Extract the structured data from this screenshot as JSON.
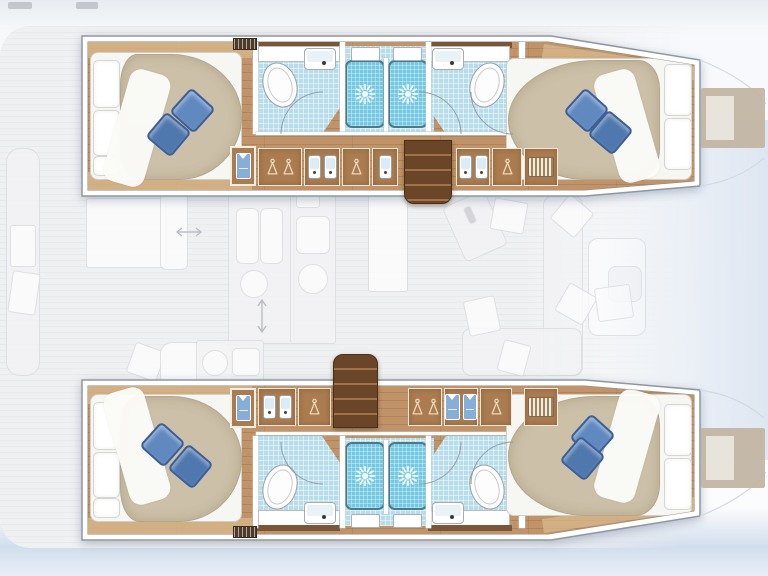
{
  "plan": {
    "vessel_type": "sailing catamaran",
    "view": "top-down interior deck plan, no text labels",
    "orientation": {
      "bow": "right",
      "stern": "left"
    },
    "hulls": [
      {
        "id": "port-hull",
        "position": "top",
        "rooms": [
          {
            "name": "aft cabin",
            "items": [
              "double bed",
              "3 white pillows",
              "2 blue decor pillows",
              "hanging locker with folded shirt",
              "louvre vent"
            ]
          },
          {
            "name": "aft bathroom",
            "items": [
              "toilet",
              "washbasin with faucet",
              "shower stall with shower rose",
              "roof hatch"
            ]
          },
          {
            "name": "corridor",
            "items": [
              "staircase down from saloon",
              "wardrobe hangers",
              "twin vanity basins",
              "single basin",
              "linen grill locker"
            ]
          },
          {
            "name": "forward bathroom",
            "items": [
              "toilet",
              "washbasin with faucet",
              "shower stall with shower rose",
              "roof hatch"
            ]
          },
          {
            "name": "forward cabin",
            "items": [
              "double bed",
              "2 white pillows",
              "2 blue decor pillows"
            ]
          },
          {
            "name": "bow",
            "items": [
              "sunpad"
            ]
          }
        ]
      },
      {
        "id": "starboard-hull",
        "position": "bottom",
        "rooms": [
          {
            "name": "aft cabin",
            "items": [
              "double bed",
              "3 white pillows",
              "2 blue decor pillows",
              "hanging locker with folded shirt",
              "louvre vent"
            ]
          },
          {
            "name": "aft bathroom",
            "items": [
              "toilet",
              "washbasin with faucet",
              "shower stall with shower rose",
              "roof hatch"
            ]
          },
          {
            "name": "corridor",
            "items": [
              "staircase down from saloon",
              "twin vanity basins",
              "wardrobe hangers",
              "folded clothes shelf",
              "linen grill locker"
            ]
          },
          {
            "name": "forward bathroom",
            "items": [
              "toilet",
              "washbasin with faucet",
              "shower stall with shower rose",
              "roof hatch"
            ]
          },
          {
            "name": "forward cabin",
            "items": [
              "double bed",
              "2 white pillows",
              "2 blue decor pillows"
            ]
          },
          {
            "name": "bow",
            "items": [
              "sunpad"
            ]
          }
        ]
      }
    ],
    "saloon_faded_layer": [
      "cockpit bench with cushions",
      "cockpit table",
      "galley double sink",
      "galley counters",
      "stove burner",
      "kitchen island",
      "nav desk",
      "saloon sofa with cushions",
      "saloon table with chair",
      "sliding-door double arrows"
    ]
  },
  "icons": [
    "shower-rose-icon",
    "hanger-icon",
    "washbasin-icon",
    "toilet-icon",
    "sink-faucet-icon",
    "folded-shirt-icon",
    "louvre-vent-icon",
    "staircase-icon",
    "double-arrow-icon",
    "door-swing-arc-icon"
  ],
  "colors": {
    "wood": "#c09468",
    "wood-light": "#d9b98e",
    "wood-trim": "#7a5636",
    "cabinet": "#ab7c4f",
    "stairs": "#6b4527",
    "stairs-step": "#a07248",
    "duvet": "#ccc0a8",
    "duvet-edge": "#b3a68c",
    "pillow1": "#6089c0",
    "pillow2": "#4f78ae",
    "pillow-edge": "#3d5f96",
    "bath": "#b7ddeb",
    "shower": "#74c9e2",
    "shower-edge": "#49798d",
    "shirt": "#85aed8",
    "faded": "#f3f3f5",
    "faded-edge": "#dcdde0",
    "bow-pad": "#c3b6a4",
    "bow-pad-inner": "#e9e3da",
    "hull-stroke": "#8f979f"
  }
}
